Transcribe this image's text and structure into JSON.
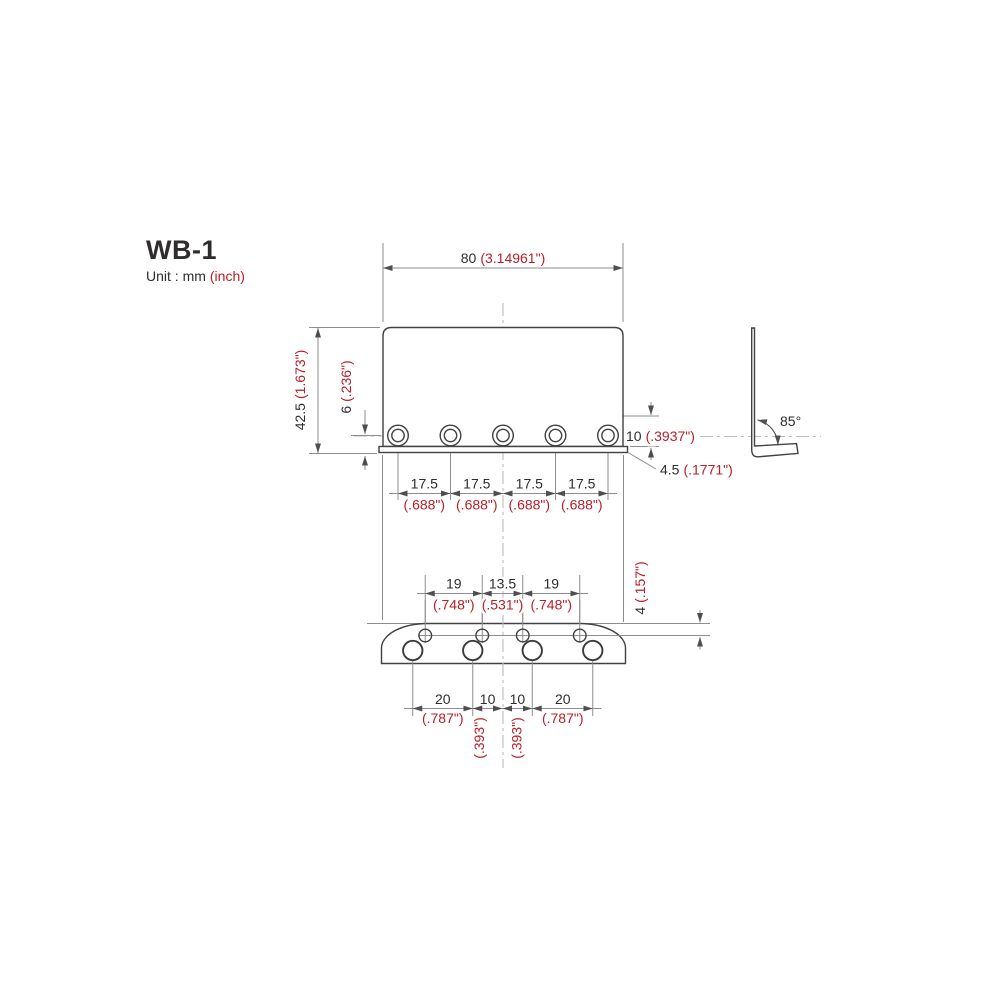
{
  "title": "WB-1",
  "unit": {
    "label": "Unit : mm",
    "inch_suffix": "(inch)"
  },
  "colors": {
    "red_accent": "#b7202a",
    "ink": "#2f2c2d",
    "object_line": "#414042",
    "dim_line": "#8d8d8d",
    "centerline": "#bdbdbd"
  },
  "dimensions": {
    "overall_width": {
      "mm": "80",
      "inch": "(3.14961\")"
    },
    "overall_height": {
      "mm": "42.5",
      "inch": "(1.673\")"
    },
    "screw_hole_offset": {
      "mm": "6",
      "inch": "(.236\")"
    },
    "flange_height": {
      "mm": "10",
      "inch": "(.3937\")"
    },
    "flange_lip": {
      "mm": "4.5",
      "inch": "(.1771\")"
    },
    "bend_angle": "85°",
    "screw_spacing": [
      {
        "mm": "17.5",
        "inch": "(.688\")"
      },
      {
        "mm": "17.5",
        "inch": "(.688\")"
      },
      {
        "mm": "17.5",
        "inch": "(.688\")"
      },
      {
        "mm": "17.5",
        "inch": "(.688\")"
      }
    ],
    "adjuster_spacing": [
      {
        "mm": "19",
        "inch": "(.748\")"
      },
      {
        "mm": "13.5",
        "inch": "(.531\")"
      },
      {
        "mm": "19",
        "inch": "(.748\")"
      }
    ],
    "edge_to_adjuster": {
      "mm": "4",
      "inch": "(.157\")"
    },
    "string_spacing": [
      {
        "mm": "20",
        "inch": "(.787\")"
      },
      {
        "mm": "10",
        "inch": "(.393\")"
      },
      {
        "mm": "10",
        "inch": "(.393\")"
      },
      {
        "mm": "20",
        "inch": "(.787\")"
      }
    ]
  }
}
